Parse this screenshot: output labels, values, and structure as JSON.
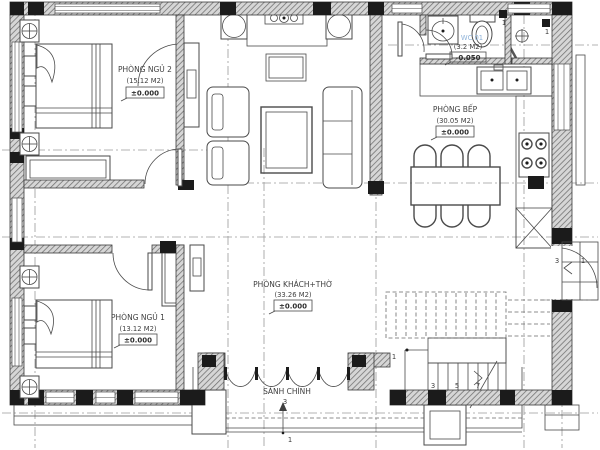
{
  "plan": {
    "rooms": {
      "bedroom2": {
        "name": "PHÒNG NGỦ 2",
        "area": "(15.12 M2)",
        "level": "±0.000"
      },
      "bedroom1": {
        "name": "PHÒNG NGỦ 1",
        "area": "(13.12 M2)",
        "level": "±0.000"
      },
      "living": {
        "name": "PHÒNG KHÁCH+THỜ",
        "area": "(33.26 M2)",
        "level": "±0.000"
      },
      "kitchen": {
        "name": "PHÒNG BẾP",
        "area": "(30.05 M2)",
        "level": "±0.000"
      },
      "wc": {
        "name": "WC 01",
        "area": "(3.2 M2)",
        "level": "-0.050"
      },
      "entrance": {
        "name": "SẢNH CHÍNH"
      }
    },
    "stairs": {
      "treads": [
        "1",
        "3",
        "5",
        "7"
      ]
    },
    "entrance_steps": {
      "upper": "3",
      "lower": "1"
    },
    "side_steps": {
      "upper": "3",
      "lower": "1"
    },
    "fixture_tags": {
      "wc_light": "1",
      "lobby_light": "1"
    },
    "colors": {
      "wall_line": "#3a3a3a",
      "hatch": "#7a7a7a",
      "wc_label": "#8fb3d9",
      "dash": "#999999"
    }
  }
}
